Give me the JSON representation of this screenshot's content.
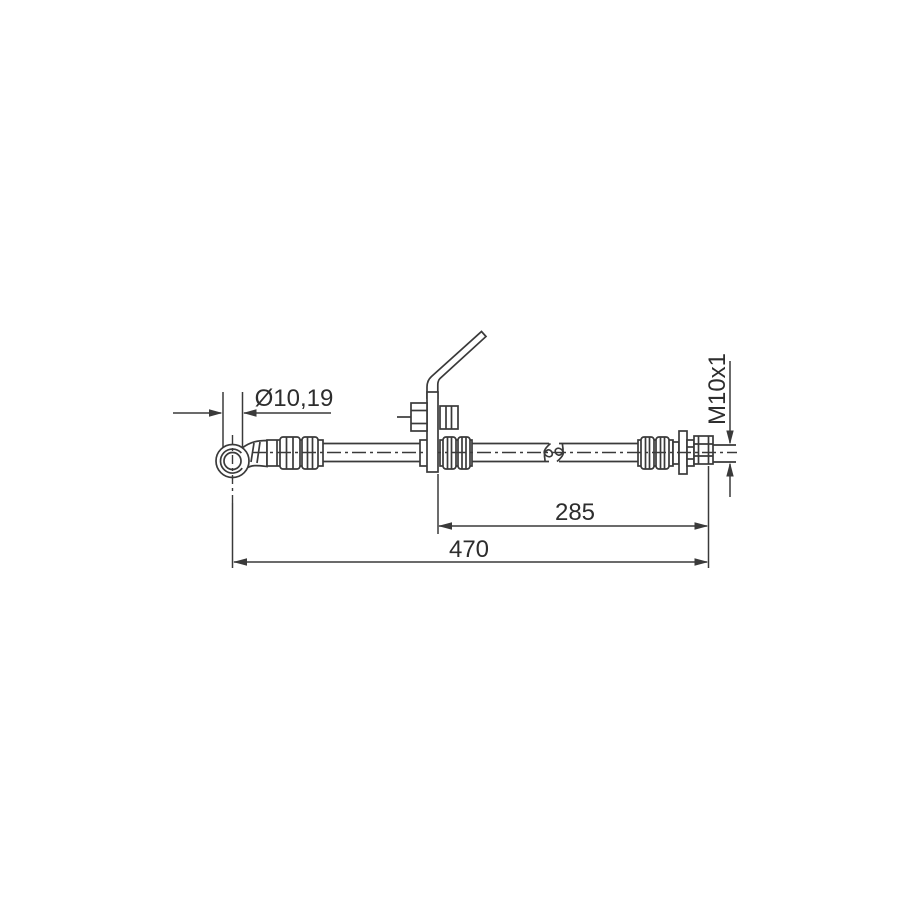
{
  "page": {
    "background": "#ffffff"
  },
  "drawing": {
    "type": "technical-line-drawing",
    "subject": "brake-hose-side-view",
    "line_color": "#3a3a3a",
    "text_color": "#2d2d2d",
    "dimensions": {
      "eye_bore_diameter": {
        "label": "Ø10,19"
      },
      "thread_size": {
        "label": "M10x1"
      },
      "bracket_to_end_length": {
        "label": "285"
      },
      "overall_length": {
        "label": "470"
      }
    }
  }
}
